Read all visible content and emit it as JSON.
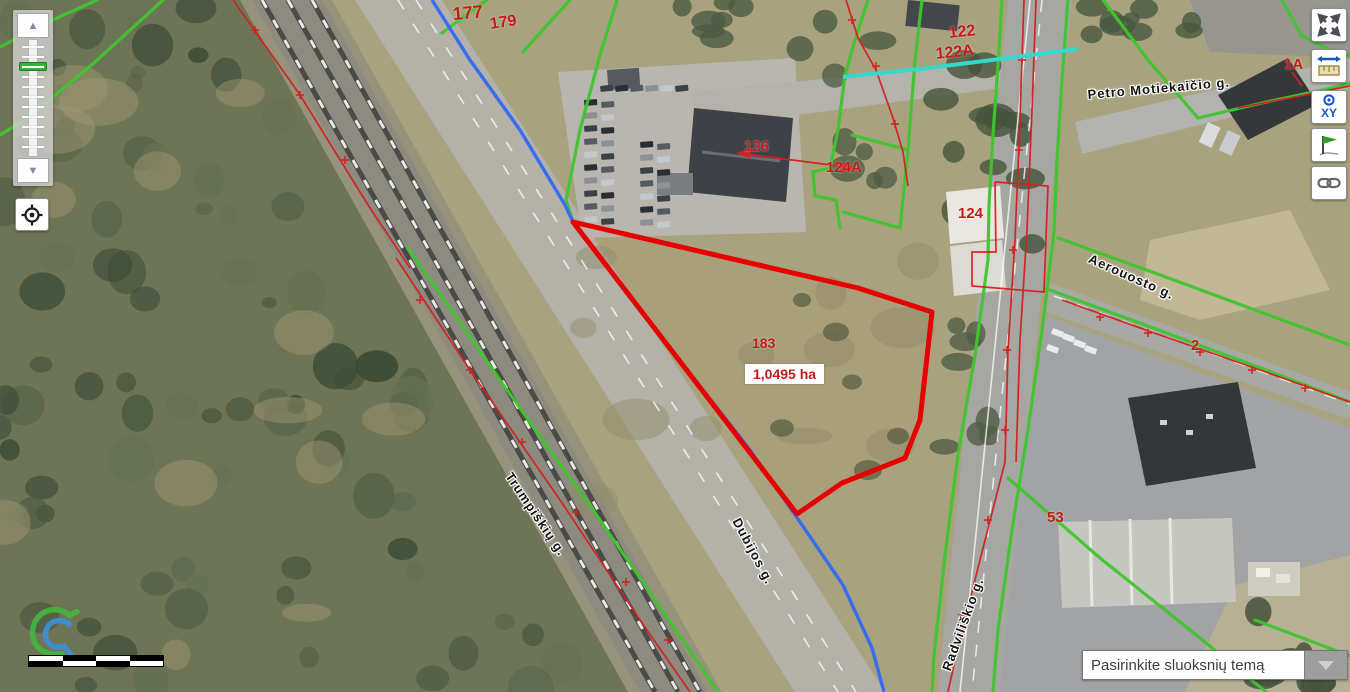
{
  "app": {
    "name": "REGIA map viewer"
  },
  "map": {
    "selected_parcel": {
      "number": "183",
      "area_label": "1,0495 ha",
      "outline_points": "573,222 858,288 932,312 920,420 905,458 842,483 797,514",
      "outline_color": "#e60000",
      "area_box_pos": {
        "x": 745,
        "y": 364
      },
      "number_pos": {
        "x": 752,
        "y": 336
      }
    },
    "parcel_labels": [
      {
        "text": "177",
        "x": 452,
        "y": 5,
        "size": 18,
        "rot": -5
      },
      {
        "text": "179",
        "x": 489,
        "y": 17,
        "size": 16,
        "rot": -8
      },
      {
        "text": "122",
        "x": 948,
        "y": 26,
        "size": 16,
        "rot": -6
      },
      {
        "text": "122A",
        "x": 935,
        "y": 47,
        "size": 16,
        "rot": -6
      },
      {
        "text": "126",
        "x": 744,
        "y": 139,
        "size": 15,
        "rot": 0
      },
      {
        "text": "124A",
        "x": 826,
        "y": 160,
        "size": 15,
        "rot": 0
      },
      {
        "text": "124",
        "x": 958,
        "y": 206,
        "size": 15,
        "rot": 0
      },
      {
        "text": "1A",
        "x": 1284,
        "y": 57,
        "size": 15,
        "rot": 0
      },
      {
        "text": "2",
        "x": 1191,
        "y": 338,
        "size": 15,
        "rot": 0
      },
      {
        "text": "53",
        "x": 1047,
        "y": 510,
        "size": 15,
        "rot": 0
      }
    ],
    "street_labels": [
      {
        "text": "Petro Motiekaičio g.",
        "x": 1087,
        "y": 88,
        "rot": -5,
        "size": 13
      },
      {
        "text": "Aerouosto g.",
        "x": 1092,
        "y": 252,
        "rot": 24,
        "size": 13
      },
      {
        "text": "Trumpiškių g.",
        "x": 514,
        "y": 470,
        "rot": 56,
        "size": 13
      },
      {
        "text": "Dubijos g.",
        "x": 742,
        "y": 516,
        "rot": 62,
        "size": 13
      },
      {
        "text": "Radviliškio g.",
        "x": 940,
        "y": 668,
        "rot": -70,
        "size": 13
      }
    ],
    "line_colors": {
      "cadastral_green": "#3fc62e",
      "cadastral_red": "#d42020",
      "utility_blue": "#3a6cf0",
      "utility_cyan": "#35d8cc"
    }
  },
  "controls": {
    "zoom_in_label": "▲",
    "zoom_out_label": "▼",
    "buttons": [
      {
        "name": "fullscreen",
        "tooltip": "Fullscreen"
      },
      {
        "name": "measure",
        "tooltip": "Measure"
      },
      {
        "name": "coordinates",
        "tooltip": "XY"
      },
      {
        "name": "flag",
        "tooltip": "Mark location"
      },
      {
        "name": "link",
        "tooltip": "Share link"
      }
    ],
    "coordinates_button_text": "XY",
    "layer_select": {
      "value": "Pasirinkite sluoksnių temą"
    }
  }
}
